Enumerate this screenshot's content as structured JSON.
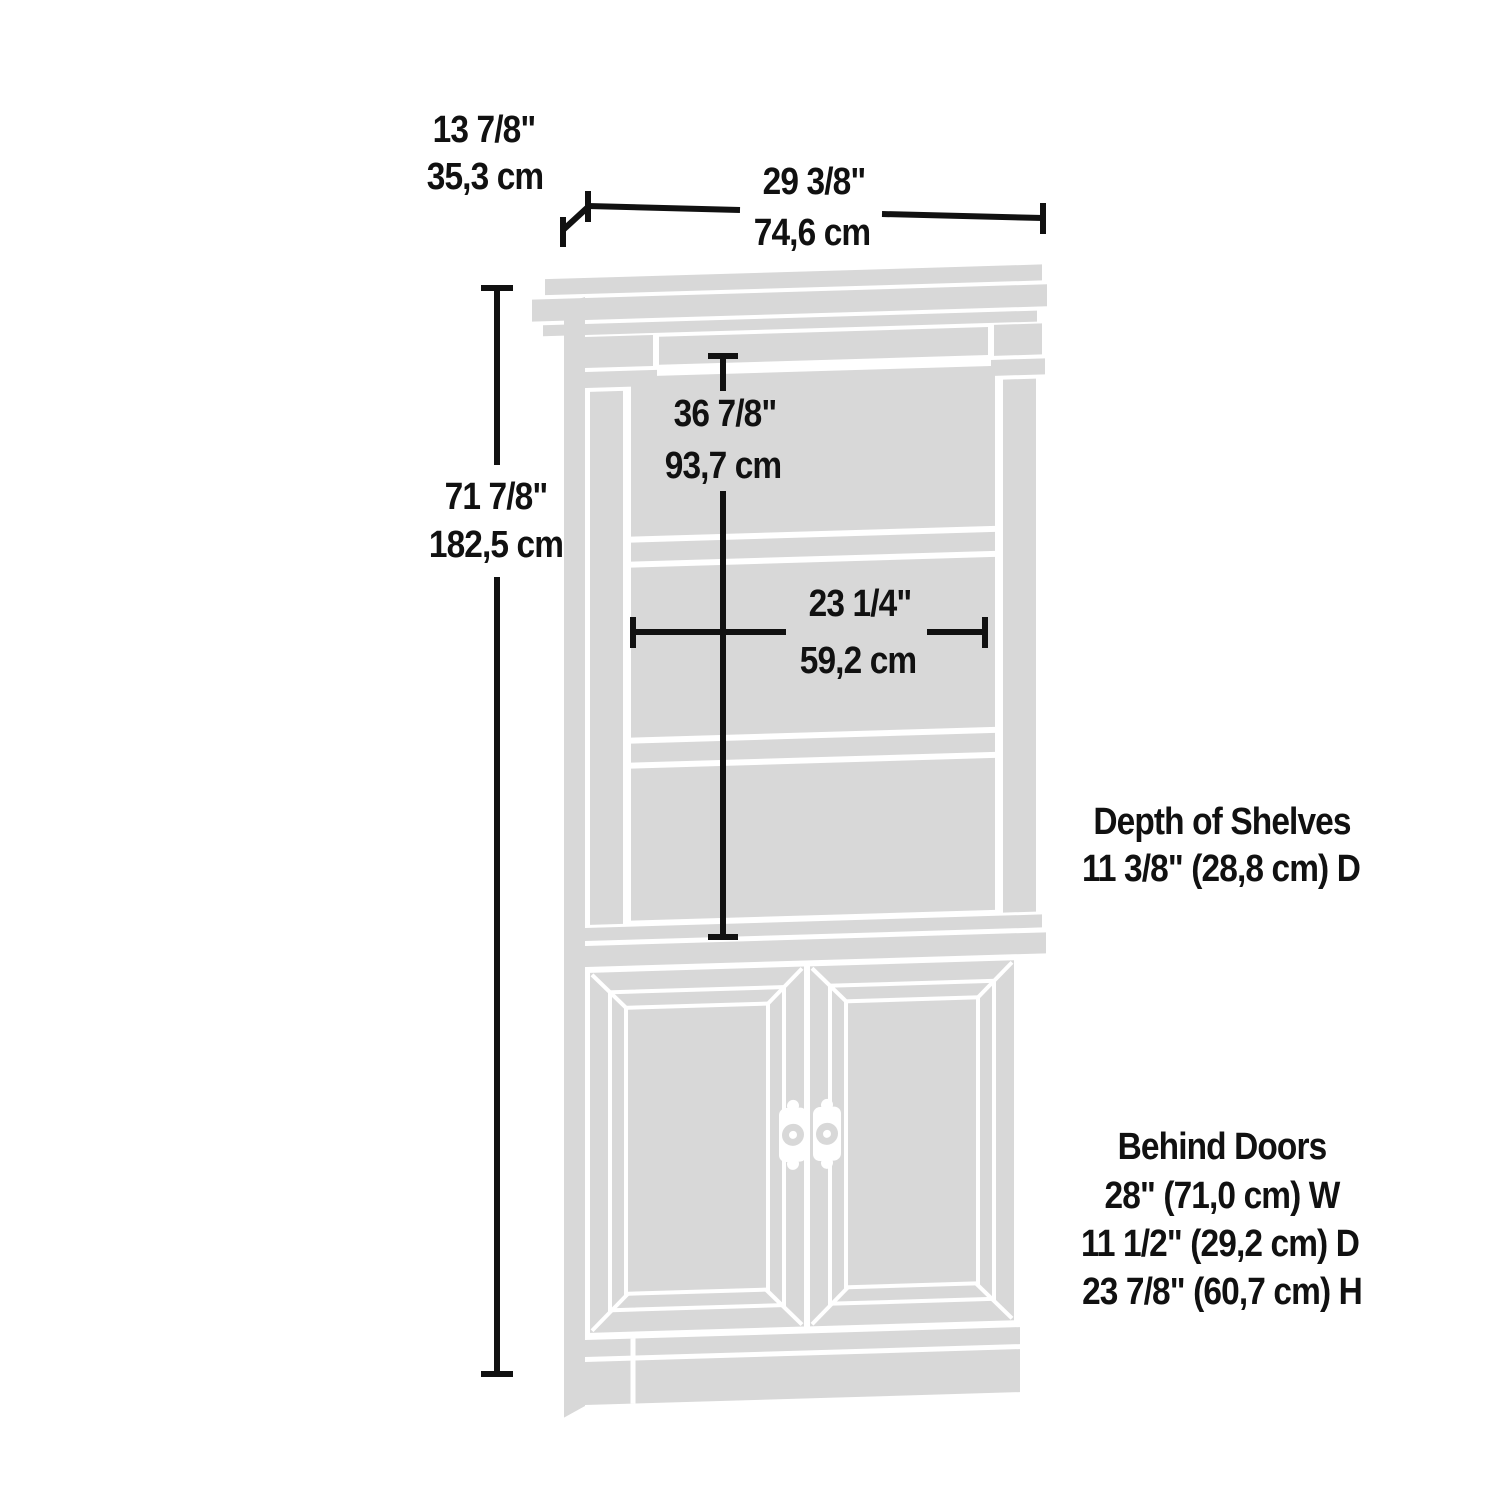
{
  "diagram": {
    "title": "Bookcase with doors dimension diagram",
    "colors": {
      "furniture_fill": "#d8d8d8",
      "dimension_line": "#111111",
      "text": "#111111",
      "background": "#ffffff"
    },
    "dimensions": {
      "depth": {
        "inches": "13 7/8\"",
        "metric": "35,3 cm"
      },
      "width": {
        "inches": "29 3/8\"",
        "metric": "74,6 cm"
      },
      "height": {
        "inches": "71 7/8\"",
        "metric": "182,5 cm"
      },
      "interior_height": {
        "inches": "36 7/8\"",
        "metric": "93,7 cm"
      },
      "interior_width": {
        "inches": "23 1/4\"",
        "metric": "59,2 cm"
      }
    },
    "annotations": {
      "shelf_depth": {
        "title": "Depth of Shelves",
        "value": "11 3/8\" (28,8 cm) D"
      },
      "behind_doors": {
        "title": "Behind Doors",
        "width": "28\" (71,0 cm) W",
        "depth": "11 1/2\" (29,2 cm) D",
        "height": "23 7/8\" (60,7 cm) H"
      }
    }
  }
}
